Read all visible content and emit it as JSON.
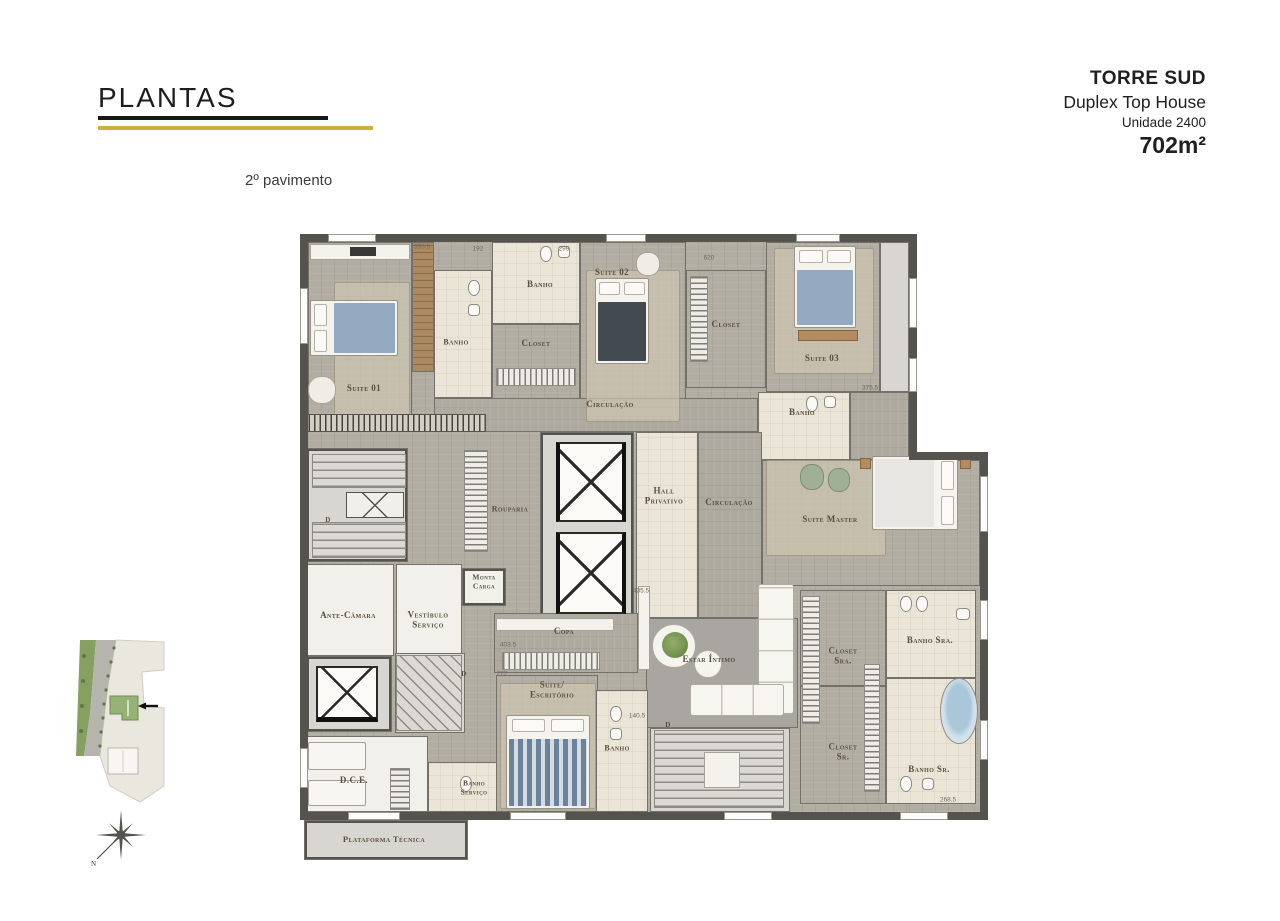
{
  "header": {
    "title": "PLANTAS",
    "floor_label": "2º pavimento"
  },
  "project": {
    "tower": "TORRE SUD",
    "type": "Duplex Top House",
    "unit": "Unidade 2400",
    "area": "702m²"
  },
  "compass": {
    "north_label": "N"
  },
  "palette": {
    "accent_gold": "#cfae3e",
    "accent_black": "#181816",
    "wall": "#55534d",
    "wood_floor": "#b2ada3",
    "carpet": "#cbc4b2",
    "tile": "#eae5d6",
    "gray_carpet": "#a9a5a0",
    "deck_wood": "#ac8a61",
    "bed_blue": "#92a9c0",
    "label_ink": "#57503f"
  },
  "plan": {
    "base": [
      {
        "f": "f-wood",
        "x": 8,
        "y": 14,
        "w": 601,
        "h": 570
      },
      {
        "f": "f-wood",
        "x": 609,
        "y": 232,
        "w": 71,
        "h": 352
      }
    ],
    "rooms": [
      {
        "id": "suite-01",
        "f": "f-wood",
        "x": 8,
        "y": 14,
        "w": 104,
        "h": 186
      },
      {
        "id": "deck-suite-01",
        "f": "f-deck",
        "x": 112,
        "y": 14,
        "w": 22,
        "h": 130
      },
      {
        "id": "banho-suite-01",
        "f": "f-tile",
        "x": 134,
        "y": 42,
        "w": 58,
        "h": 128
      },
      {
        "id": "banho-suite-02",
        "f": "f-tile",
        "x": 192,
        "y": 14,
        "w": 88,
        "h": 82
      },
      {
        "id": "closet-suite-02",
        "f": "f-wood",
        "x": 192,
        "y": 96,
        "w": 88,
        "h": 76
      },
      {
        "id": "suite-02",
        "f": "f-wood",
        "x": 280,
        "y": 14,
        "w": 106,
        "h": 188
      },
      {
        "id": "closet-suite-03",
        "f": "f-wood",
        "x": 386,
        "y": 42,
        "w": 80,
        "h": 118
      },
      {
        "id": "suite-03",
        "f": "f-wood",
        "x": 466,
        "y": 14,
        "w": 114,
        "h": 150
      },
      {
        "id": "shaft-top-right",
        "f": "f-stair",
        "x": 580,
        "y": 14,
        "w": 29,
        "h": 150
      },
      {
        "id": "banho-suite-03",
        "f": "f-tile",
        "x": 458,
        "y": 164,
        "w": 92,
        "h": 68
      },
      {
        "id": "circulacao-top",
        "f": "f-woodh",
        "x": 134,
        "y": 170,
        "w": 324,
        "h": 34
      },
      {
        "id": "circulacao-link",
        "f": "f-woodh",
        "x": 550,
        "y": 164,
        "w": 59,
        "h": 68
      },
      {
        "id": "escada-emergencia",
        "f": "f-stair",
        "x": 6,
        "y": 220,
        "w": 102,
        "h": 114,
        "wb": true
      },
      {
        "id": "nucleo-elevadores",
        "f": "f-stair",
        "x": 240,
        "y": 204,
        "w": 94,
        "h": 190,
        "wb": true
      },
      {
        "id": "hall-privativo",
        "f": "f-tile",
        "x": 336,
        "y": 204,
        "w": 62,
        "h": 186
      },
      {
        "id": "circulacao-meio",
        "f": "f-woodh",
        "x": 398,
        "y": 204,
        "w": 64,
        "h": 186
      },
      {
        "id": "suite-master",
        "f": "f-wood",
        "x": 462,
        "y": 232,
        "w": 218,
        "h": 126
      },
      {
        "id": "monta-carga",
        "f": "f-white",
        "x": 162,
        "y": 340,
        "w": 44,
        "h": 38,
        "wb": true
      },
      {
        "id": "ante-camara",
        "f": "f-white",
        "x": 6,
        "y": 336,
        "w": 88,
        "h": 92
      },
      {
        "id": "vestibulo-servico",
        "f": "f-white",
        "x": 96,
        "y": 336,
        "w": 66,
        "h": 92
      },
      {
        "id": "copa",
        "f": "f-woodh",
        "x": 194,
        "y": 385,
        "w": 144,
        "h": 60
      },
      {
        "id": "estar-intimo",
        "f": "f-gcarpet",
        "x": 346,
        "y": 390,
        "w": 152,
        "h": 110
      },
      {
        "id": "escada-interna",
        "f": "f-stair",
        "x": 350,
        "y": 500,
        "w": 140,
        "h": 84
      },
      {
        "id": "closet-sra",
        "f": "f-wood",
        "x": 500,
        "y": 362,
        "w": 86,
        "h": 96
      },
      {
        "id": "closet-sr",
        "f": "f-wood",
        "x": 500,
        "y": 458,
        "w": 86,
        "h": 118
      },
      {
        "id": "banho-sra",
        "f": "f-tile",
        "x": 586,
        "y": 362,
        "w": 90,
        "h": 88
      },
      {
        "id": "banho-sr",
        "f": "f-tile",
        "x": 586,
        "y": 450,
        "w": 90,
        "h": 126
      },
      {
        "id": "elevador-servico",
        "f": "f-stair",
        "x": 6,
        "y": 428,
        "w": 86,
        "h": 76,
        "wb": true
      },
      {
        "id": "escada-caracol",
        "f": "f-stair",
        "x": 95,
        "y": 425,
        "w": 70,
        "h": 80
      },
      {
        "id": "dce",
        "f": "f-white",
        "x": 6,
        "y": 508,
        "w": 122,
        "h": 76
      },
      {
        "id": "banho-servico",
        "f": "f-tile",
        "x": 128,
        "y": 534,
        "w": 76,
        "h": 50
      },
      {
        "id": "suite-escritorio",
        "f": "f-wood",
        "x": 196,
        "y": 447,
        "w": 102,
        "h": 137
      },
      {
        "id": "banho-escritorio",
        "f": "f-tile",
        "x": 296,
        "y": 462,
        "w": 52,
        "h": 122
      },
      {
        "id": "plataforma-tecnica",
        "f": "f-stair",
        "x": 4,
        "y": 592,
        "w": 164,
        "h": 40,
        "wb": true
      }
    ],
    "walls": [
      {
        "x": 0,
        "y": 6,
        "w": 617,
        "h": 8
      },
      {
        "x": 0,
        "y": 6,
        "w": 8,
        "h": 586
      },
      {
        "x": 609,
        "y": 6,
        "w": 8,
        "h": 226
      },
      {
        "x": 609,
        "y": 224,
        "w": 79,
        "h": 8
      },
      {
        "x": 680,
        "y": 224,
        "w": 8,
        "h": 360
      },
      {
        "x": 0,
        "y": 584,
        "w": 688,
        "h": 8
      }
    ],
    "windows": [
      {
        "x": 0,
        "y": 60,
        "w": 8,
        "h": 56
      },
      {
        "x": 0,
        "y": 520,
        "w": 8,
        "h": 40
      },
      {
        "x": 28,
        "y": 6,
        "w": 48,
        "h": 8
      },
      {
        "x": 306,
        "y": 6,
        "w": 40,
        "h": 8
      },
      {
        "x": 496,
        "y": 6,
        "w": 44,
        "h": 8
      },
      {
        "x": 609,
        "y": 50,
        "w": 8,
        "h": 50
      },
      {
        "x": 609,
        "y": 130,
        "w": 8,
        "h": 34
      },
      {
        "x": 680,
        "y": 248,
        "w": 8,
        "h": 56
      },
      {
        "x": 680,
        "y": 372,
        "w": 8,
        "h": 40
      },
      {
        "x": 680,
        "y": 492,
        "w": 8,
        "h": 40
      },
      {
        "x": 48,
        "y": 584,
        "w": 52,
        "h": 8
      },
      {
        "x": 210,
        "y": 584,
        "w": 56,
        "h": 8
      },
      {
        "x": 424,
        "y": 584,
        "w": 48,
        "h": 8
      },
      {
        "x": 600,
        "y": 584,
        "w": 48,
        "h": 8
      }
    ],
    "furniture": [
      {
        "t": "rug",
        "n": "rug",
        "x": 34,
        "y": 54,
        "w": 76,
        "h": 136
      },
      {
        "t": "rug",
        "n": "rug",
        "x": 286,
        "y": 42,
        "w": 94,
        "h": 152
      },
      {
        "t": "rug",
        "n": "rug",
        "x": 474,
        "y": 20,
        "w": 100,
        "h": 126
      },
      {
        "t": "rug",
        "n": "rug",
        "x": 466,
        "y": 232,
        "w": 120,
        "h": 96
      },
      {
        "t": "rug",
        "n": "rug",
        "x": 200,
        "y": 455,
        "w": 96,
        "h": 126
      },
      {
        "t": "bed bed-h",
        "n": "bed-suite-01",
        "x": 10,
        "y": 72,
        "w": 88,
        "h": 56,
        "bl": "#92a9c0"
      },
      {
        "t": "bed bed-v bed-dark",
        "n": "bed-suite-02",
        "x": 295,
        "y": 50,
        "w": 54,
        "h": 86
      },
      {
        "t": "bed bed-v",
        "n": "bed-suite-03",
        "x": 494,
        "y": 18,
        "w": 62,
        "h": 82,
        "bl": "#92a9c0"
      },
      {
        "t": "bed bed-hr bed-light",
        "n": "bed-suite-master",
        "x": 572,
        "y": 228,
        "w": 86,
        "h": 74
      },
      {
        "t": "bed bed-v bed-striped",
        "n": "bed-escritorio",
        "x": 206,
        "y": 487,
        "w": 84,
        "h": 94
      },
      {
        "t": "bed-plain",
        "n": "bed-dce",
        "x": 8,
        "y": 514,
        "w": 58,
        "h": 28
      },
      {
        "t": "bed-plain",
        "n": "bed-dce",
        "x": 8,
        "y": 552,
        "w": 58,
        "h": 26
      },
      {
        "t": "sofa sofa-v",
        "n": "sofa",
        "x": 458,
        "y": 356,
        "w": 36,
        "h": 130
      },
      {
        "t": "sofa sofa-h",
        "n": "sofa",
        "x": 390,
        "y": 456,
        "w": 94,
        "h": 32
      },
      {
        "t": "shelf",
        "n": "sideboard",
        "x": 338,
        "y": 358,
        "w": 12,
        "h": 84
      },
      {
        "t": "table",
        "n": "coffee-table",
        "x": 352,
        "y": 396,
        "w": 44,
        "h": 44
      },
      {
        "t": "plant",
        "n": "plant",
        "x": 362,
        "y": 404,
        "w": 26,
        "h": 26
      },
      {
        "t": "table",
        "n": "side-table",
        "x": 394,
        "y": 422,
        "w": 28,
        "h": 28
      },
      {
        "t": "elev",
        "n": "elevator",
        "x": 256,
        "y": 214,
        "w": 70,
        "h": 80
      },
      {
        "t": "elev",
        "n": "elevator",
        "x": 256,
        "y": 304,
        "w": 70,
        "h": 82
      },
      {
        "t": "elev elev-s",
        "n": "service-elevator",
        "x": 16,
        "y": 438,
        "w": 62,
        "h": 56
      },
      {
        "t": "stair-v",
        "n": "stair-run",
        "x": 12,
        "y": 226,
        "w": 94,
        "h": 34
      },
      {
        "t": "xbox",
        "n": "stair-landing",
        "x": 46,
        "y": 264,
        "w": 58,
        "h": 26
      },
      {
        "t": "stair-v",
        "n": "stair-run",
        "x": 12,
        "y": 294,
        "w": 94,
        "h": 36
      },
      {
        "t": "stair-diag",
        "n": "winder-stair",
        "x": 96,
        "y": 427,
        "w": 66,
        "h": 76
      },
      {
        "t": "stair-v",
        "n": "main-stair",
        "x": 354,
        "y": 502,
        "w": 130,
        "h": 78
      },
      {
        "t": "shelf",
        "n": "stair-landing",
        "x": 404,
        "y": 524,
        "w": 36,
        "h": 36
      },
      {
        "t": "rack-v",
        "n": "rouparia-cabinet",
        "x": 164,
        "y": 222,
        "w": 24,
        "h": 102
      },
      {
        "t": "rack-h",
        "n": "copa-rack",
        "x": 202,
        "y": 424,
        "w": 98,
        "h": 18
      },
      {
        "t": "rack-v",
        "n": "closet-rack",
        "x": 502,
        "y": 368,
        "w": 18,
        "h": 128
      },
      {
        "t": "rack-v",
        "n": "closet-rack",
        "x": 564,
        "y": 436,
        "w": 16,
        "h": 128
      },
      {
        "t": "rack-v",
        "n": "wardrobe",
        "x": 90,
        "y": 540,
        "w": 20,
        "h": 42
      },
      {
        "t": "rack-h",
        "n": "closet-rack",
        "x": 196,
        "y": 140,
        "w": 80,
        "h": 18
      },
      {
        "t": "rack-v",
        "n": "closet-rack",
        "x": 390,
        "y": 48,
        "w": 18,
        "h": 86
      },
      {
        "t": "hatch",
        "n": "louver-strip",
        "x": 2,
        "y": 186,
        "w": 184,
        "h": 18
      },
      {
        "t": "tub",
        "n": "bathtub",
        "x": 640,
        "y": 450,
        "w": 38,
        "h": 66
      },
      {
        "t": "wc",
        "n": "toilet",
        "x": 168,
        "y": 52,
        "w": 12,
        "h": 16
      },
      {
        "t": "sink",
        "n": "sink",
        "x": 168,
        "y": 76,
        "w": 12,
        "h": 12
      },
      {
        "t": "wc",
        "n": "toilet",
        "x": 240,
        "y": 18,
        "w": 12,
        "h": 16
      },
      {
        "t": "sink",
        "n": "sink",
        "x": 258,
        "y": 18,
        "w": 12,
        "h": 12
      },
      {
        "t": "wc",
        "n": "toilet",
        "x": 506,
        "y": 168,
        "w": 12,
        "h": 16
      },
      {
        "t": "sink",
        "n": "sink",
        "x": 524,
        "y": 168,
        "w": 12,
        "h": 12
      },
      {
        "t": "wc",
        "n": "toilet",
        "x": 600,
        "y": 368,
        "w": 12,
        "h": 16
      },
      {
        "t": "wc",
        "n": "bidet",
        "x": 616,
        "y": 368,
        "w": 12,
        "h": 16
      },
      {
        "t": "sink",
        "n": "sink",
        "x": 656,
        "y": 380,
        "w": 14,
        "h": 12
      },
      {
        "t": "wc",
        "n": "toilet",
        "x": 600,
        "y": 548,
        "w": 12,
        "h": 16
      },
      {
        "t": "sink",
        "n": "sink",
        "x": 622,
        "y": 550,
        "w": 12,
        "h": 12
      },
      {
        "t": "wc",
        "n": "toilet",
        "x": 160,
        "y": 548,
        "w": 12,
        "h": 16
      },
      {
        "t": "wc",
        "n": "toilet",
        "x": 310,
        "y": 478,
        "w": 12,
        "h": 16
      },
      {
        "t": "sink",
        "n": "sink",
        "x": 310,
        "y": 500,
        "w": 12,
        "h": 12
      },
      {
        "t": "chair",
        "n": "armchair",
        "x": 8,
        "y": 148,
        "w": 28,
        "h": 28
      },
      {
        "t": "chair",
        "n": "armchair",
        "x": 336,
        "y": 24,
        "w": 24,
        "h": 24
      },
      {
        "t": "chair-g",
        "n": "armchair",
        "x": 500,
        "y": 236,
        "w": 24,
        "h": 26
      },
      {
        "t": "chair-g",
        "n": "armchair",
        "x": 528,
        "y": 240,
        "w": 22,
        "h": 24
      },
      {
        "t": "shelf",
        "n": "media-shelf",
        "x": 10,
        "y": 16,
        "w": 100,
        "h": 16
      },
      {
        "t": "tv",
        "n": "tv",
        "x": 50,
        "y": 19,
        "w": 26,
        "h": 9
      },
      {
        "t": "counter",
        "n": "kitchen-counter",
        "x": 196,
        "y": 390,
        "w": 118,
        "h": 13
      },
      {
        "t": "woodpc",
        "n": "bench",
        "x": 498,
        "y": 102,
        "w": 60,
        "h": 11
      },
      {
        "t": "woodpc",
        "n": "nightstand",
        "x": 560,
        "y": 230,
        "w": 11,
        "h": 11
      },
      {
        "t": "woodpc",
        "n": "nightstand",
        "x": 660,
        "y": 230,
        "w": 11,
        "h": 11
      }
    ],
    "labels": [
      {
        "t": "Suite 01",
        "x": 64,
        "y": 160
      },
      {
        "t": "Banho",
        "x": 156,
        "y": 114,
        "fs": 8
      },
      {
        "t": "Banho",
        "x": 240,
        "y": 56
      },
      {
        "t": "Closet",
        "x": 236,
        "y": 115
      },
      {
        "t": "Suite 02",
        "x": 312,
        "y": 44
      },
      {
        "t": "Closet",
        "x": 426,
        "y": 96
      },
      {
        "t": "Suite 03",
        "x": 522,
        "y": 130
      },
      {
        "t": "Banho",
        "x": 502,
        "y": 184
      },
      {
        "t": "Circulação",
        "x": 310,
        "y": 176
      },
      {
        "t": "Rouparia",
        "x": 210,
        "y": 281,
        "fs": 8
      },
      {
        "t": "Monta\nCarga",
        "x": 184,
        "y": 354,
        "fs": 7.5
      },
      {
        "t": "Ante-Câmara",
        "x": 48,
        "y": 387
      },
      {
        "t": "Vestíbulo\nServiço",
        "x": 128,
        "y": 392
      },
      {
        "t": "Hall\nPrivativo",
        "x": 364,
        "y": 268
      },
      {
        "t": "Circulação",
        "x": 429,
        "y": 274
      },
      {
        "t": "Suite Master",
        "x": 530,
        "y": 291
      },
      {
        "t": "Copa",
        "x": 264,
        "y": 403
      },
      {
        "t": "Estar Íntimo",
        "x": 409,
        "y": 431
      },
      {
        "t": "Closet\nSra.",
        "x": 543,
        "y": 428
      },
      {
        "t": "Closet\nSr.",
        "x": 543,
        "y": 524
      },
      {
        "t": "Banho Sra.",
        "x": 630,
        "y": 412
      },
      {
        "t": "Banho Sr.",
        "x": 629,
        "y": 541
      },
      {
        "t": "D.C.E.",
        "x": 54,
        "y": 552
      },
      {
        "t": "Banho\nServiço",
        "x": 174,
        "y": 560,
        "fs": 7.5
      },
      {
        "t": "Suite/\nEscritório",
        "x": 252,
        "y": 462
      },
      {
        "t": "Banho",
        "x": 317,
        "y": 520,
        "fs": 8
      },
      {
        "t": "Plataforma Técnica",
        "x": 84,
        "y": 612,
        "fs": 8.5
      },
      {
        "t": "D",
        "x": 28,
        "y": 292,
        "fs": 7
      },
      {
        "t": "D",
        "x": 164,
        "y": 446,
        "fs": 7
      },
      {
        "t": "D",
        "x": 368,
        "y": 497,
        "fs": 7
      }
    ],
    "dims": [
      {
        "t": "395.5",
        "x": 122,
        "y": 19
      },
      {
        "t": "192",
        "x": 178,
        "y": 21
      },
      {
        "t": "299",
        "x": 264,
        "y": 21
      },
      {
        "t": "620",
        "x": 409,
        "y": 30
      },
      {
        "t": "375.5",
        "x": 570,
        "y": 160
      },
      {
        "t": "435.5",
        "x": 341,
        "y": 363
      },
      {
        "t": "403.5",
        "x": 208,
        "y": 417
      },
      {
        "t": "272",
        "x": 202,
        "y": 446
      },
      {
        "t": "140.5",
        "x": 337,
        "y": 488
      },
      {
        "t": "268.5",
        "x": 648,
        "y": 572
      }
    ]
  }
}
